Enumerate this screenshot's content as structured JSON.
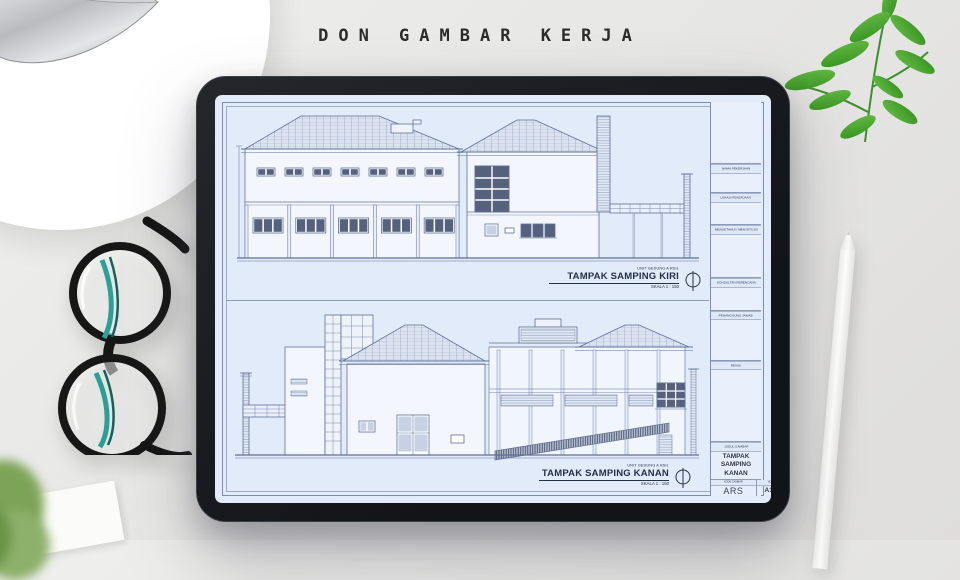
{
  "heading": {
    "text": "DON GAMBAR KERJA"
  },
  "tablet": {
    "sheet": {
      "drawings": [
        {
          "unit": "UNIT GEDUNG A RSIL",
          "title": "TAMPAK SAMPING KIRI",
          "scale": "SKALA 1 : 150"
        },
        {
          "unit": "UNIT GEDUNG A RSIL",
          "title": "TAMPAK SAMPING KANAN",
          "scale": "SKALA 1 : 150"
        }
      ],
      "titleblock": {
        "rows": [
          {
            "label": "NAMA PEKERJAAN"
          },
          {
            "label": "LOKASI PEKERJAAN"
          },
          {
            "label": "MENGETAHUI / MENYETUJUI"
          },
          {
            "label": "KONSULTAN PERENCANA"
          },
          {
            "label": "PENANGGUNG JAWAB"
          },
          {
            "label": "REVISI"
          },
          {
            "label": "JUDUL GAMBAR"
          }
        ],
        "judul_gambar_value": "TAMPAK SAMPING KANAN",
        "kode_gambar_label": "KODE GAMBAR",
        "kode_gambar_value": "ARS",
        "no_lembar_label": "NO. LEMBAR",
        "no_lembar_value": "A1-009"
      }
    }
  },
  "colors": {
    "screen_bg": "#e2ebf9",
    "drawing_line": "#5f7096",
    "bezel": "#1d1f24",
    "desk": "#e9e9e7",
    "leaf_green": "#4aa832",
    "glasses_teal": "#2aa198"
  }
}
